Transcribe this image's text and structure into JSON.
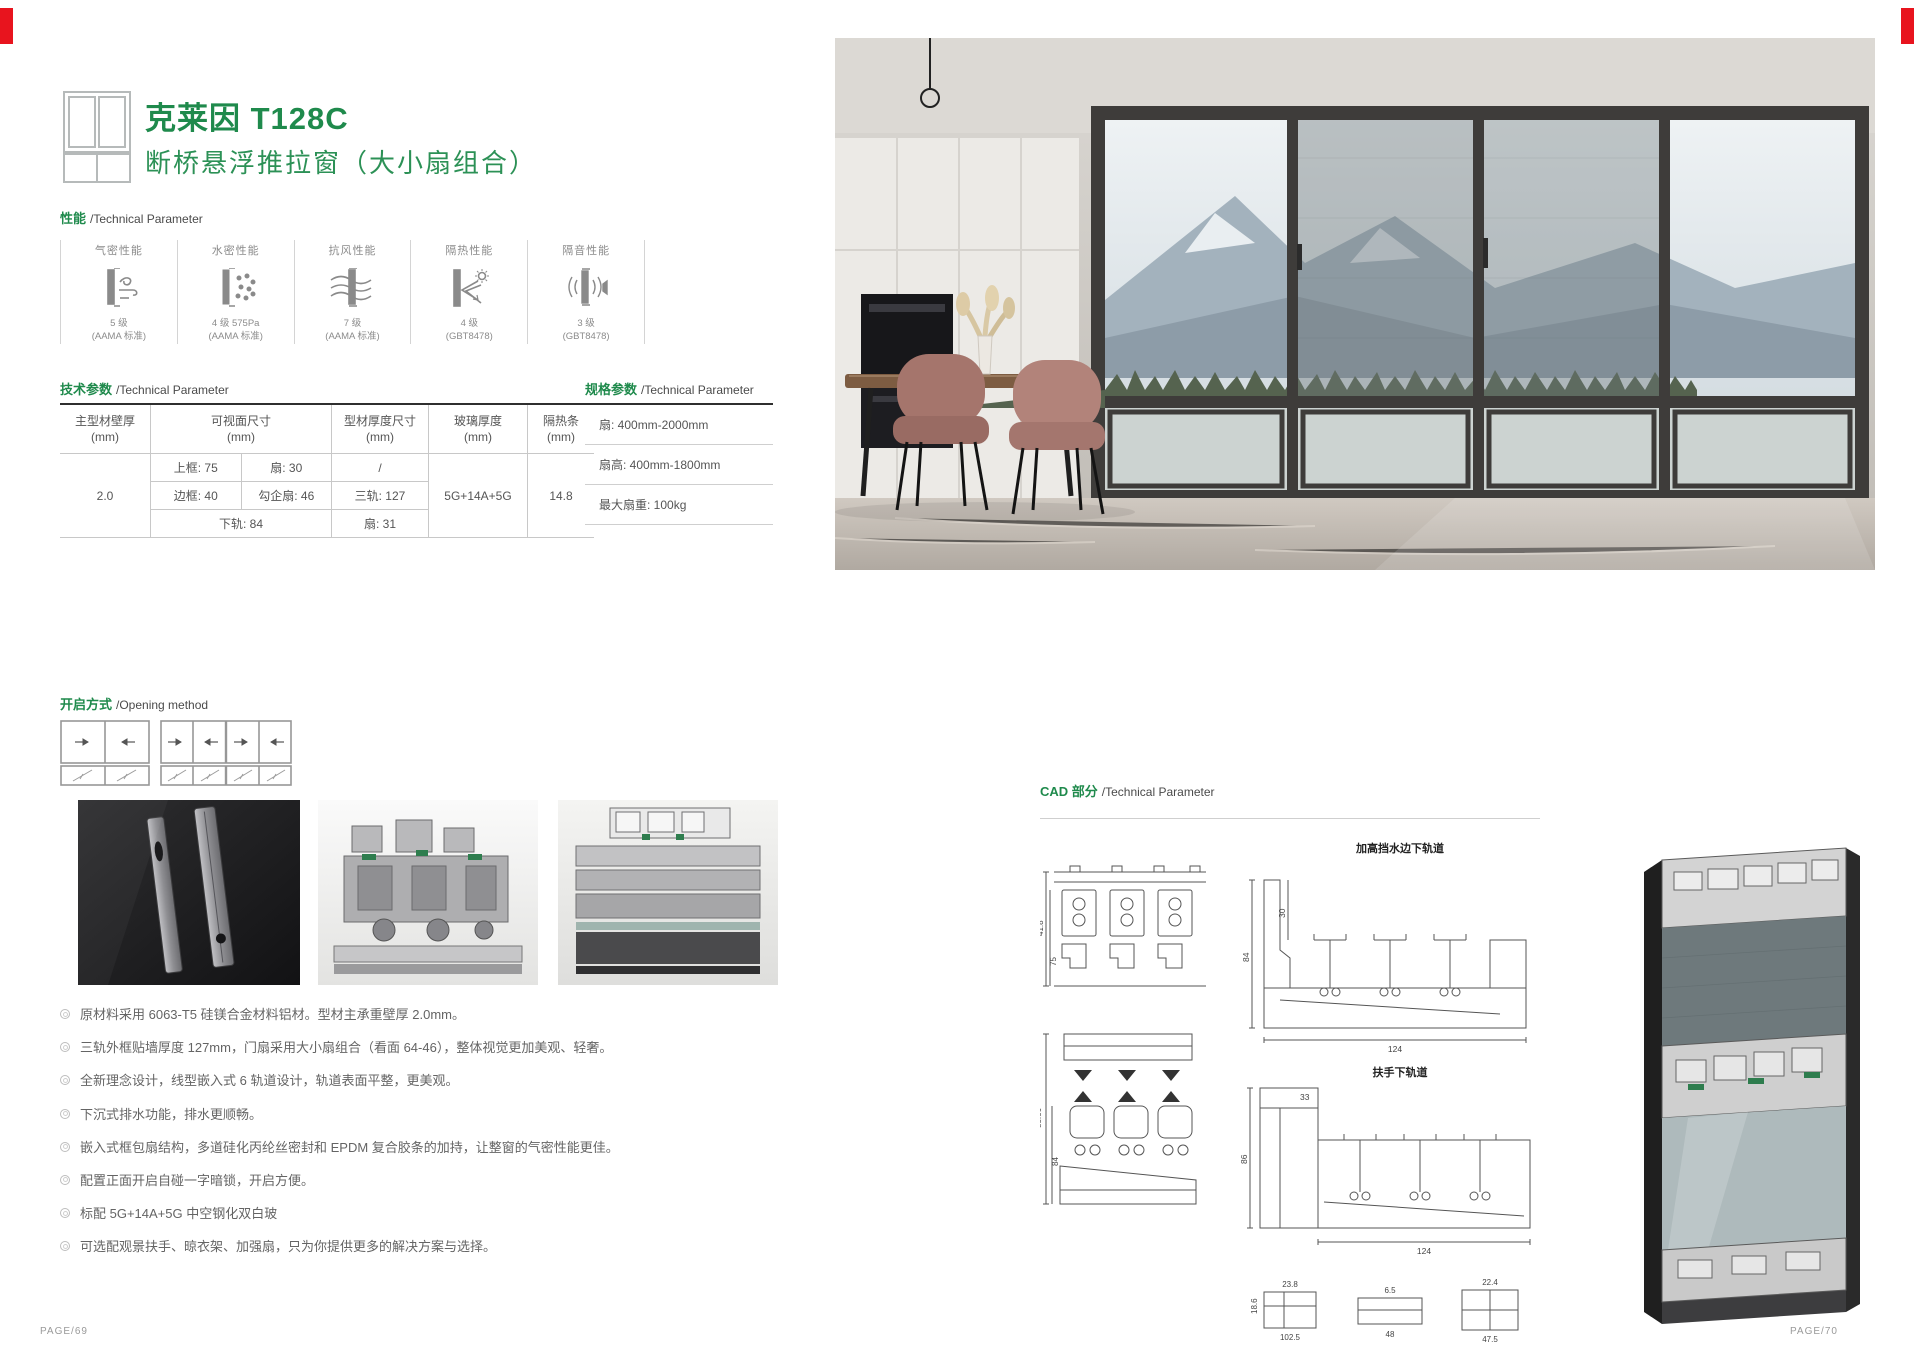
{
  "page_left": {
    "page_number": "PAGE/69",
    "title": "克莱因 T128C",
    "subtitle": "断桥悬浮推拉窗（大小扇组合）",
    "perf_header": {
      "zh": "性能",
      "en": "/Technical Parameter"
    },
    "perf_items": [
      {
        "name": "气密性能",
        "rating": "5 级",
        "standard": "(AAMA 标准)"
      },
      {
        "name": "水密性能",
        "rating": "4 级 575Pa",
        "standard": "(AAMA 标准)"
      },
      {
        "name": "抗风性能",
        "rating": "7 级",
        "standard": "(AAMA 标准)"
      },
      {
        "name": "隔热性能",
        "rating": "4 级",
        "standard": "(GBT8478)"
      },
      {
        "name": "隔音性能",
        "rating": "3 级",
        "standard": "(GBT8478)"
      }
    ],
    "tech_header": {
      "zh": "技术参数",
      "en": "/Technical Parameter"
    },
    "tech_table": {
      "h1": "主型材壁厚\n(mm)",
      "h2": "可视面尺寸\n(mm)",
      "h3": "型材厚度尺寸\n(mm)",
      "h4": "玻璃厚度\n(mm)",
      "h5": "隔热条\n(mm)",
      "wall": "2.0",
      "r1c1": "上框: 75",
      "r1c2": "扇: 30",
      "r1c3": "/",
      "r2c1": "边框: 40",
      "r2c2": "勾企扇: 46",
      "r2c3": "三轨: 127",
      "r3c12": "下轨: 84",
      "r3c3": "扇: 31",
      "glass": "5G+14A+5G",
      "strip": "14.8"
    },
    "spec_header": {
      "zh": "规格参数",
      "en": "/Technical Parameter"
    },
    "spec_rows": [
      "扇: 400mm-2000mm",
      "扇高: 400mm-1800mm",
      "最大扇重: 100kg"
    ],
    "opening_header": {
      "zh": "开启方式",
      "en": "/Opening method"
    },
    "features": [
      "原材料采用 6063-T5 硅镁合金材料铝材。型材主承重壁厚 2.0mm。",
      "三轨外框贴墙厚度 127mm，门扇采用大小扇组合（看面 64-46），整体视觉更加美观、轻奢。",
      "全新理念设计，线型嵌入式 6 轨道设计，轨道表面平整，更美观。",
      "下沉式排水功能，排水更顺畅。",
      "嵌入式框包扇结构，多道硅化丙纶丝密封和 EPDM 复合胶条的加持，让整窗的气密性能更佳。",
      "配置正面开启自碰一字暗锁，开启方便。",
      "标配 5G+14A+5G 中空钢化双白玻",
      "可选配观景扶手、晾衣架、加强扇，只为你提供更多的解决方案与选择。"
    ]
  },
  "page_right": {
    "page_number": "PAGE/70",
    "cad_header": {
      "zh": "CAD 部分",
      "en": "/Technical Parameter"
    },
    "cad_labels": {
      "raised_sill": "加高挡水边下轨道",
      "handrail_sill": "扶手下轨道"
    },
    "cad_dims": {
      "a0": "41.8",
      "a1": "75",
      "b1": "88.66",
      "b2": "84",
      "c1": "30",
      "c2": "84",
      "c3": "124",
      "d1": "33",
      "d2": "86",
      "d3": "124",
      "s1": "23.8",
      "s2": "22.4",
      "s3": "6.5",
      "s4": "48",
      "s5": "47.5",
      "s6": "102.5",
      "s7": "18.6"
    }
  }
}
